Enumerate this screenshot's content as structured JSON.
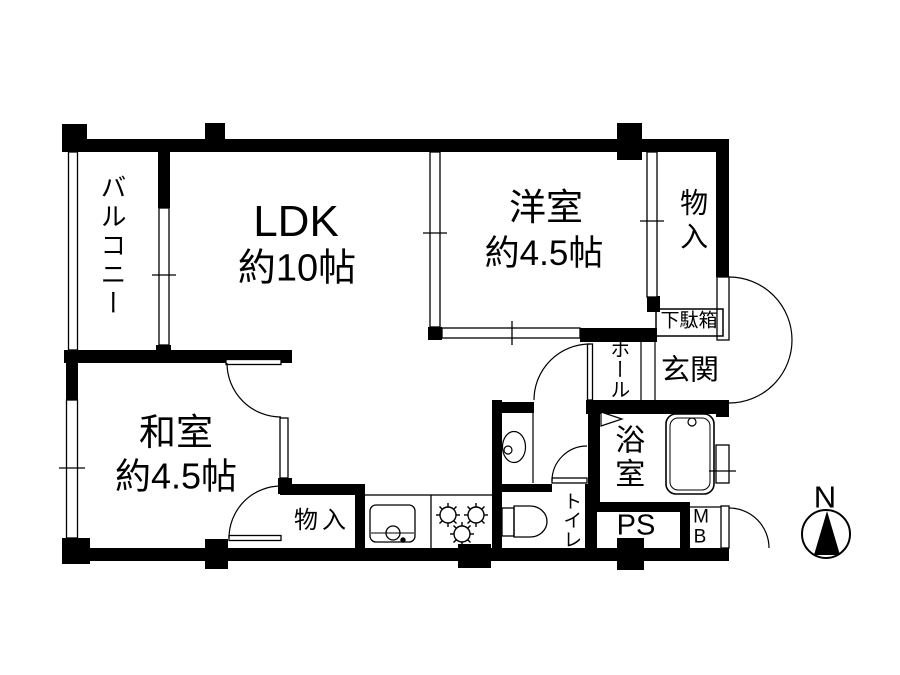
{
  "page": {
    "background": "#ffffff",
    "line_color": "#000000",
    "wall_color": "#000000"
  },
  "compass": {
    "label": "N"
  },
  "rooms": {
    "balcony": {
      "label": "バルコニー"
    },
    "ldk": {
      "label": "LDK",
      "size": "約10帖"
    },
    "western_room": {
      "label": "洋室",
      "size": "約4.5帖"
    },
    "storage_upper": {
      "label": "物入"
    },
    "shoe_cabinet": {
      "label": "下駄箱"
    },
    "hall": {
      "label": "ホール"
    },
    "entrance": {
      "label": "玄関"
    },
    "japanese_room": {
      "label": "和室",
      "size": "約4.5帖"
    },
    "storage_lower": {
      "label": "物入"
    },
    "toilet": {
      "label": "トイレ"
    },
    "bathroom": {
      "label": "浴室"
    },
    "pipe_space": {
      "label": "PS"
    },
    "meter_box": {
      "line1": "M",
      "line2": "B"
    }
  }
}
